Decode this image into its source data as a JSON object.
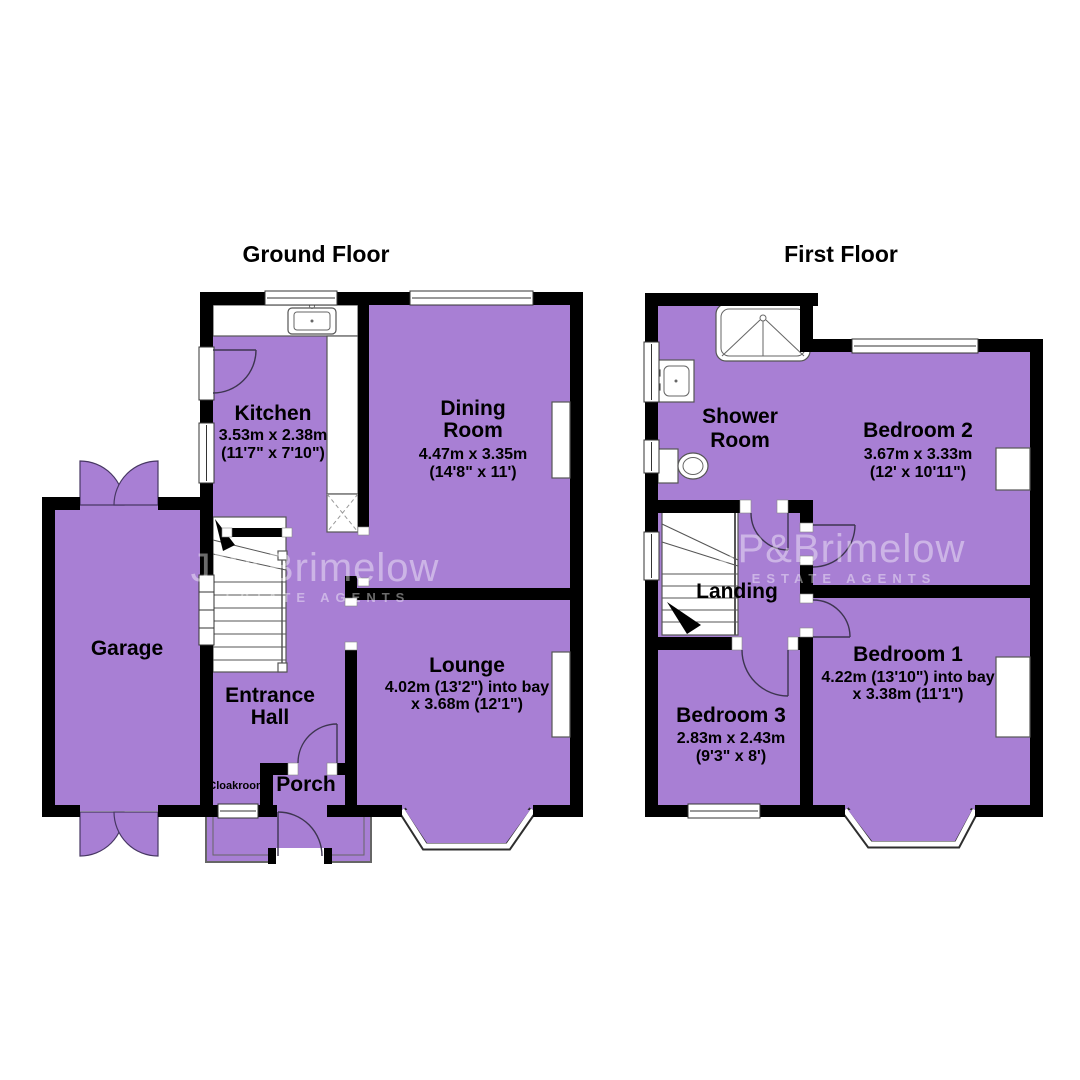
{
  "meta": {
    "room_fill": "#A87FD4",
    "wall_color": "#000000",
    "background": "#FFFFFF",
    "text_color": "#000000",
    "watermark_color": "rgba(255,255,255,0.42)"
  },
  "titles": {
    "ground": "Ground Floor",
    "first": "First Floor"
  },
  "watermark": {
    "brand": "JP&Brimelow",
    "tagline": "ESTATE AGENTS"
  },
  "ground_floor": {
    "rooms": {
      "kitchen": {
        "name": "Kitchen",
        "dims_m": "3.53m x 2.38m",
        "dims_ft": "(11'7\" x 7'10\")"
      },
      "dining": {
        "name_line1": "Dining",
        "name_line2": "Room",
        "dims_m": "4.47m x 3.35m",
        "dims_ft": "(14'8\" x 11')"
      },
      "lounge": {
        "name": "Lounge",
        "dims_line1": "4.02m (13'2\") into bay",
        "dims_line2": "x 3.68m (12'1\")"
      },
      "entrance_hall": {
        "name_line1": "Entrance",
        "name_line2": "Hall"
      },
      "garage": {
        "name": "Garage"
      },
      "porch": {
        "name": "Porch"
      },
      "cloakroom": {
        "name": "Cloakroom"
      }
    }
  },
  "first_floor": {
    "rooms": {
      "shower_room": {
        "name_line1": "Shower",
        "name_line2": "Room"
      },
      "bedroom2": {
        "name": "Bedroom 2",
        "dims_m": "3.67m x 3.33m",
        "dims_ft": "(12' x 10'11\")"
      },
      "bedroom1": {
        "name": "Bedroom 1",
        "dims_line1": "4.22m (13'10\") into bay",
        "dims_line2": "x 3.38m (11'1\")"
      },
      "bedroom3": {
        "name": "Bedroom 3",
        "dims_m": "2.83m x 2.43m",
        "dims_ft": "(9'3\" x 8')"
      },
      "landing": {
        "name": "Landing"
      }
    }
  }
}
